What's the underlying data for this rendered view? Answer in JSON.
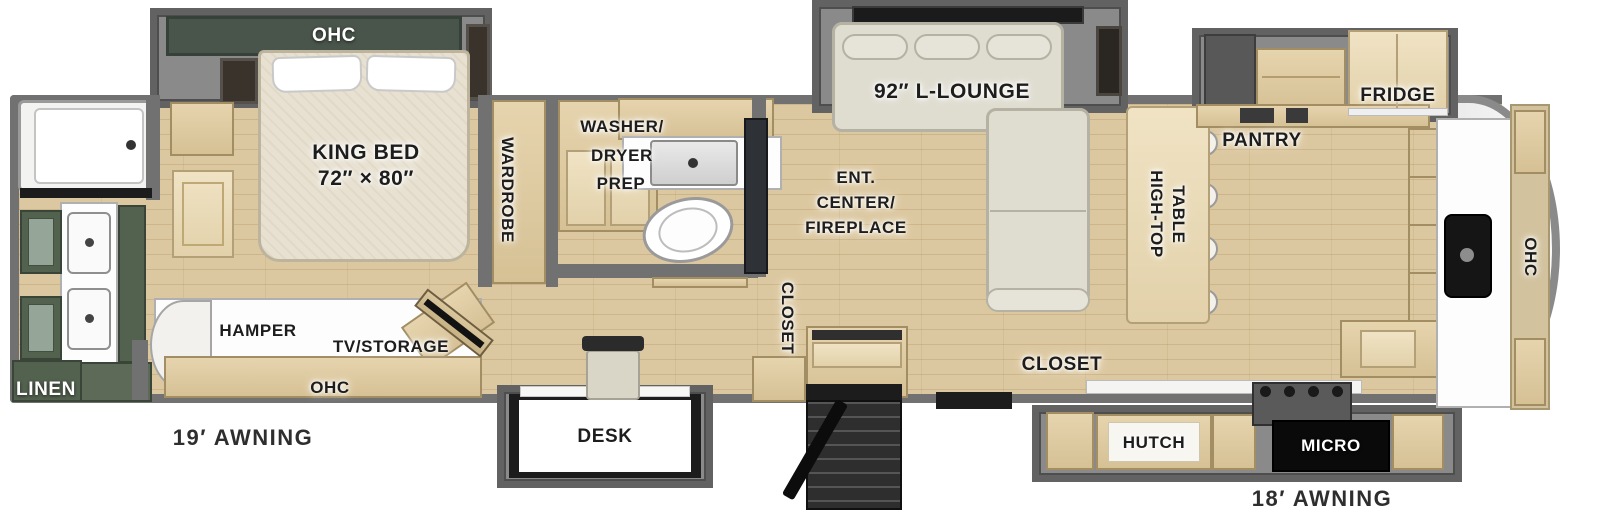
{
  "labels": {
    "bedroom_ohc": "OHC",
    "king_bed_1": "KING BED",
    "king_bed_2": "72″ × 80″",
    "wardrobe": "WARDROBE",
    "washer_1": "WASHER/",
    "washer_2": "DRYER",
    "washer_3": "PREP",
    "hamper": "HAMPER",
    "tv_storage": "TV/STORAGE",
    "ohc_left": "OHC",
    "linen": "LINEN",
    "awning_left": "19′ AWNING",
    "desk": "DESK",
    "closet_entry": "CLOSET",
    "ent_1": "ENT.",
    "ent_2": "CENTER/",
    "ent_3": "FIREPLACE",
    "lounge": "92″ L-LOUNGE",
    "high_top_1": "HIGH-TOP",
    "high_top_2": "TABLE",
    "pantry": "PANTRY",
    "fridge": "FRIDGE",
    "closet_kitchen": "CLOSET",
    "hutch": "HUTCH",
    "micro": "MICRO",
    "ohc_rear": "OHC",
    "awning_right": "18′ AWNING"
  },
  "colors": {
    "floor_wood": "#dcc8a0",
    "wall_gray": "#717171",
    "cabinet_green": "#53614f",
    "sofa_fabric": "#dfdcd0",
    "furniture_wood": "#e0cda6",
    "appliance_black": "#111111"
  }
}
